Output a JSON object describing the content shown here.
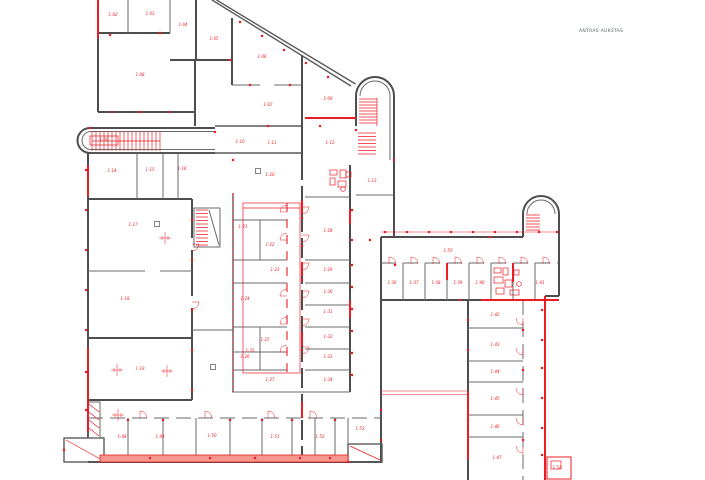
{
  "note": {
    "text": "ANTRAS AUKŠTAS"
  },
  "colors": {
    "wall": "#4d4d4d",
    "red": "#ec1c24",
    "base_fill": "#f4978f"
  },
  "plan": {
    "room_labels": [
      [
        113,
        16,
        "1-02"
      ],
      [
        150,
        15,
        "1-03"
      ],
      [
        183,
        26,
        "1-04"
      ],
      [
        214,
        40,
        "1-05"
      ],
      [
        262,
        58,
        "1-06"
      ],
      [
        268,
        106,
        "1-07"
      ],
      [
        140,
        76,
        "1-08"
      ],
      [
        328,
        100,
        "1-09"
      ],
      [
        240,
        143,
        "1-10"
      ],
      [
        272,
        144,
        "1-11"
      ],
      [
        330,
        144,
        "1-12"
      ],
      [
        372,
        182,
        "1-13"
      ],
      [
        112,
        172,
        "1-14"
      ],
      [
        150,
        171,
        "1-15"
      ],
      [
        182,
        170,
        "1-16"
      ],
      [
        133,
        226,
        "1-17"
      ],
      [
        125,
        300,
        "1-18"
      ],
      [
        140,
        370,
        "1-19"
      ],
      [
        270,
        176,
        "1-20"
      ],
      [
        243,
        228,
        "1-21"
      ],
      [
        270,
        246,
        "1-22"
      ],
      [
        275,
        271,
        "1-23"
      ],
      [
        245,
        300,
        "1-24"
      ],
      [
        265,
        341,
        "1-25"
      ],
      [
        245,
        358,
        "1-26"
      ],
      [
        270,
        381,
        "1-27"
      ],
      [
        328,
        232,
        "1-28"
      ],
      [
        328,
        271,
        "1-29"
      ],
      [
        328,
        293,
        "1-30"
      ],
      [
        328,
        313,
        "1-31"
      ],
      [
        328,
        338,
        "1-32"
      ],
      [
        328,
        358,
        "1-33"
      ],
      [
        328,
        381,
        "1-34"
      ],
      [
        250,
        352,
        "1-35"
      ],
      [
        392,
        284,
        "1-36"
      ],
      [
        414,
        284,
        "1-37"
      ],
      [
        436,
        284,
        "1-38"
      ],
      [
        458,
        284,
        "1-39"
      ],
      [
        480,
        284,
        "1-40"
      ],
      [
        540,
        284,
        "1-41"
      ],
      [
        495,
        316,
        "1-42"
      ],
      [
        495,
        346,
        "1-43"
      ],
      [
        495,
        373,
        "1-44"
      ],
      [
        495,
        400,
        "1-45"
      ],
      [
        495,
        428,
        "1-46"
      ],
      [
        497,
        459,
        "1-47"
      ],
      [
        122,
        438,
        "1-48"
      ],
      [
        160,
        438,
        "1-49"
      ],
      [
        212,
        437,
        "1-50"
      ],
      [
        275,
        438,
        "1-51"
      ],
      [
        320,
        438,
        "1-52"
      ],
      [
        360,
        430,
        "1-53"
      ],
      [
        557,
        469,
        "1-54"
      ],
      [
        448,
        252,
        "1-55"
      ],
      [
        104,
        141,
        "1-56"
      ]
    ],
    "door_arcs": [
      [
        302,
        207,
        90
      ],
      [
        302,
        235,
        90
      ],
      [
        302,
        263,
        90
      ],
      [
        302,
        291,
        90
      ],
      [
        302,
        319,
        90
      ],
      [
        302,
        347,
        90
      ],
      [
        287,
        212,
        270
      ],
      [
        287,
        240,
        270
      ],
      [
        287,
        296,
        270
      ],
      [
        287,
        324,
        270
      ],
      [
        287,
        352,
        270
      ],
      [
        389,
        264,
        0
      ],
      [
        411,
        264,
        0
      ],
      [
        433,
        264,
        0
      ],
      [
        455,
        264,
        0
      ],
      [
        477,
        264,
        0
      ],
      [
        499,
        264,
        0
      ],
      [
        521,
        264,
        0
      ],
      [
        543,
        264,
        0
      ],
      [
        523,
        318,
        180
      ],
      [
        523,
        348,
        180
      ],
      [
        523,
        388,
        180
      ],
      [
        523,
        418,
        180
      ],
      [
        523,
        446,
        180
      ],
      [
        140,
        418,
        0
      ],
      [
        205,
        418,
        0
      ],
      [
        268,
        418,
        0
      ],
      [
        310,
        418,
        0
      ],
      [
        192,
        244,
        90
      ],
      [
        192,
        302,
        90
      ]
    ],
    "crosshairs": [
      [
        165,
        238
      ],
      [
        117,
        370
      ],
      [
        167,
        371
      ],
      [
        118,
        415
      ]
    ],
    "squares": [
      [
        157,
        224
      ],
      [
        213,
        367
      ],
      [
        258,
        171
      ]
    ],
    "hatches": [
      [
        92,
        131,
        68,
        20,
        4,
        "v"
      ],
      [
        359,
        99,
        18,
        25,
        3,
        "h"
      ],
      [
        358,
        133,
        18,
        24,
        3.5,
        "h"
      ],
      [
        526,
        215,
        14,
        17,
        3,
        "h"
      ],
      [
        196,
        210,
        12,
        35,
        3.5,
        "h"
      ]
    ],
    "ticks": [
      [
        385,
        232
      ],
      [
        407,
        232
      ],
      [
        429,
        232
      ],
      [
        451,
        232
      ],
      [
        473,
        232
      ],
      [
        495,
        232
      ],
      [
        517,
        232
      ],
      [
        539,
        232
      ],
      [
        557,
        232
      ],
      [
        352,
        210
      ],
      [
        352,
        240
      ],
      [
        352,
        265
      ],
      [
        352,
        287
      ],
      [
        352,
        309
      ],
      [
        352,
        331
      ],
      [
        352,
        353
      ],
      [
        352,
        375
      ],
      [
        542,
        310
      ],
      [
        542,
        340
      ],
      [
        542,
        368
      ],
      [
        542,
        398
      ],
      [
        542,
        428
      ],
      [
        542,
        455
      ],
      [
        150,
        458
      ],
      [
        210,
        458
      ],
      [
        255,
        458
      ],
      [
        300,
        458
      ],
      [
        330,
        458
      ],
      [
        86,
        170
      ],
      [
        86,
        210
      ],
      [
        86,
        250
      ],
      [
        86,
        290
      ],
      [
        86,
        330
      ],
      [
        86,
        372
      ],
      [
        86,
        410
      ],
      [
        110,
        35
      ],
      [
        160,
        33
      ],
      [
        230,
        60
      ],
      [
        250,
        85
      ],
      [
        290,
        85
      ],
      [
        240,
        22
      ],
      [
        262,
        36
      ],
      [
        284,
        50
      ],
      [
        306,
        63
      ],
      [
        328,
        77
      ],
      [
        302,
        218
      ],
      [
        302,
        246
      ],
      [
        302,
        280
      ],
      [
        302,
        350
      ],
      [
        370,
        240
      ],
      [
        395,
        265
      ],
      [
        460,
        300
      ],
      [
        490,
        237
      ],
      [
        394,
        160
      ],
      [
        356,
        130
      ],
      [
        320,
        126
      ],
      [
        268,
        126
      ],
      [
        233,
        160
      ],
      [
        215,
        132
      ],
      [
        90,
        128
      ],
      [
        64,
        450
      ],
      [
        348,
        462
      ],
      [
        381,
        410
      ],
      [
        381,
        440
      ],
      [
        468,
        320
      ],
      [
        468,
        350
      ],
      [
        468,
        420
      ],
      [
        523,
        330
      ],
      [
        523,
        370
      ],
      [
        523,
        440
      ],
      [
        192,
        220
      ],
      [
        192,
        260
      ],
      [
        192,
        310
      ],
      [
        192,
        350
      ],
      [
        192,
        390
      ],
      [
        128,
        420
      ],
      [
        163,
        420
      ],
      [
        230,
        420
      ],
      [
        262,
        420
      ],
      [
        292,
        420
      ],
      [
        335,
        420
      ],
      [
        112,
        112
      ],
      [
        140,
        112
      ],
      [
        170,
        112
      ]
    ]
  }
}
